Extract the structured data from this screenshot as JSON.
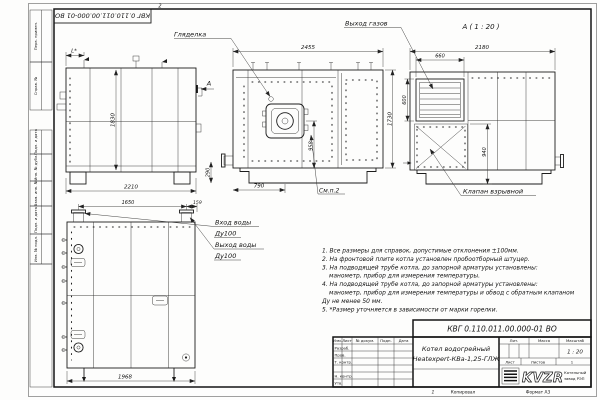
{
  "frame": {
    "designation_top": "КВГ 0.110.011.00.000-01 ВО",
    "zone_top": "2",
    "zone_bottom": "1",
    "copied_label": "Копировал",
    "format_label": "Формат А3"
  },
  "margin_stamps": {
    "perv_primen": "Перв. примен.",
    "sprav_no": "Справ. №",
    "podp_data_1": "Подп. и дата",
    "inv_dubl": "Инв. № дубл.",
    "vzam_inv": "Взам. инв. №",
    "podp_data_2": "Подп. и дата",
    "inv_podl": "Инв. № подл."
  },
  "views": {
    "side": {
      "dim_height": "1830",
      "dim_width": "2210",
      "dim_l": "L*",
      "section_label": "А"
    },
    "front": {
      "label_gliadelka": "Гляделка",
      "label_smp2": "См.п.2",
      "dim_width": "2455",
      "dim_height": "1730",
      "dim_958": "958",
      "dim_790": "790",
      "dim_290": "290"
    },
    "viewA": {
      "title": "А ( 1 : 20 )",
      "label_gas": "Выход газов",
      "label_valve": "Клапан взрывной",
      "dim_width": "2180",
      "dim_660": "660",
      "dim_600": "600",
      "dim_940": "940"
    },
    "rear": {
      "label_in1": "Вход воды",
      "label_in2": "Ду100",
      "label_out1": "Выход воды",
      "label_out2": "Ду100",
      "dim_1650": "1650",
      "dim_159": "159",
      "dim_1968": "1968"
    }
  },
  "notes": {
    "lines": [
      "1. Все размеры для справок, допустимые отклонения ±100мм.",
      "2. На фронтовой плите котла установлен пробоотборный штуцер.",
      "3. На подводящей трубе котла, до запорной арматуры установлены:",
      "манометр, прибор для измерения температуры.",
      "4. На подводящей трубе котла, до запорной арматуры установлены:",
      "манометр, прибор для измерения температуры и обвод с обратным клапаном",
      "Ду не менее 50 мм.",
      "5. *Размер уточняется в зависимости от марки горелки."
    ]
  },
  "title_block": {
    "designation": "КВГ 0.110.011.00.000-01 ВО",
    "product_line1": "Котел водогрейный",
    "product_line2": "Heatexpert-КВа-1,25-ГЛЖ",
    "col_izm": "Изм.",
    "col_list": "Лист",
    "col_doc": "№ докум.",
    "col_podp": "Подп.",
    "col_data": "Дата",
    "row_razrab": "Разраб.",
    "row_prov": "Пров.",
    "row_tkontr": "Т. контр.",
    "row_nkontr": "Н. контр.",
    "row_utv": "Утв.",
    "lit_label": "Лит.",
    "mass_label": "Масса",
    "scale_label": "Масштаб",
    "scale_value": "1 : 20",
    "sheet_label": "Лист",
    "sheets_label": "Листов",
    "sheets_value": "1",
    "logo_text": "KVZR",
    "logo_caption1": "Котельный",
    "logo_caption2": "завод РЭП"
  }
}
